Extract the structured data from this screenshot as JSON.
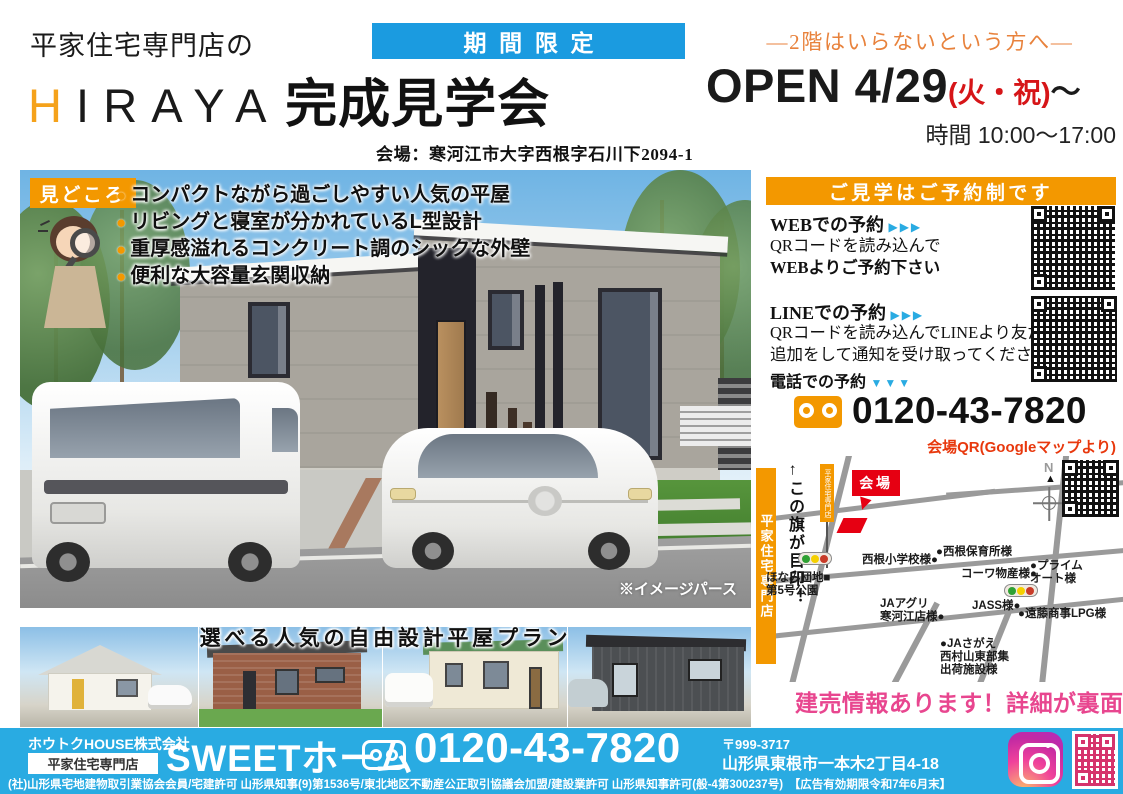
{
  "header": {
    "shop_line": "平家住宅専門店の",
    "brand_accent": "H",
    "brand_rest": "IRAYA",
    "event": "完成見学会",
    "badge": "期間限定",
    "audience": "―2階はいらないという方へ―",
    "open_main": "OPEN 4/29",
    "open_paren": "(火・祝)",
    "open_tail": "〜",
    "hours": "時間 10:00〜17:00",
    "venue": "会場：寒河江市大字西根字石川下2094-1"
  },
  "highlights": {
    "badge": "見どころ",
    "dot": "●",
    "items": [
      "コンパクトながら過ごしやすい人気の平屋",
      "リビングと寝室が分かれているL型設計",
      "重厚感溢れるコンクリート調のシックな外壁",
      "便利な大容量玄関収納"
    ]
  },
  "main_image": {
    "caption": "※イメージパース"
  },
  "reservation": {
    "header": "ご見学はご予約制です",
    "web_title": "WEBでの予約",
    "web_arrows": "▶▶▶",
    "web_line1": "QRコードを読み込んで",
    "web_line2": "WEBよりご予約下さい",
    "line_title": "LINEでの予約",
    "line_arrows": "▶▶▶",
    "line_line1": "QRコードを読み込んでLINEより友だち",
    "line_line2": "追加をして通知を受け取ってください",
    "tel_title": "電話での予約",
    "tel_arrows": "▼▼▼",
    "phone": "0120-43-7820"
  },
  "map": {
    "qr_caption": "会場QR(Googleマップより)",
    "banner_vertical": "平家住宅専門店",
    "flag_note": "←この旗が目印！",
    "flag_label": "平家住宅専門店",
    "venue_badge": "会場",
    "compass_n": "N",
    "compass_arrow": "▲",
    "labels": [
      "西根小学校様●",
      "●西根保育所様",
      "コーワ物産様●",
      "●プライム\nオート様",
      "ほなみ団地■\n第5号公園",
      "JAアグリ\n寒河江店様●",
      "JASS様●",
      "●遠藤商事LPG様",
      "●JAさがえ\n西村山東部集\n出荷施設様"
    ]
  },
  "plans": {
    "heading": "選べる人気の自由設計平屋プラン"
  },
  "promo": {
    "text": "建売情報あります！詳細が裏面へ",
    "arrow": "➡"
  },
  "footer": {
    "company": "ホウトクHOUSE株式会社",
    "store_badge": "平家住宅専門店",
    "brand": "SWEETホーム",
    "phone": "0120-43-7820",
    "postal": "〒999-3717",
    "address": "山形県東根市一本木2丁目4-18",
    "legal": "(社)山形県宅地建物取引業協会会員/宅建許可 山形県知事(9)第1536号/東北地区不動産公正取引協議会加盟/建設業許可 山形県知事許可(般-4第300237号)　【広告有効期限令和7年6月末】"
  },
  "colors": {
    "orange": "#f39800",
    "blue_badge": "#1b9be0",
    "footer_blue": "#29abe2",
    "red": "#e60012",
    "pink": "#e8468f",
    "brand_h_orange": "#f5a21b"
  }
}
